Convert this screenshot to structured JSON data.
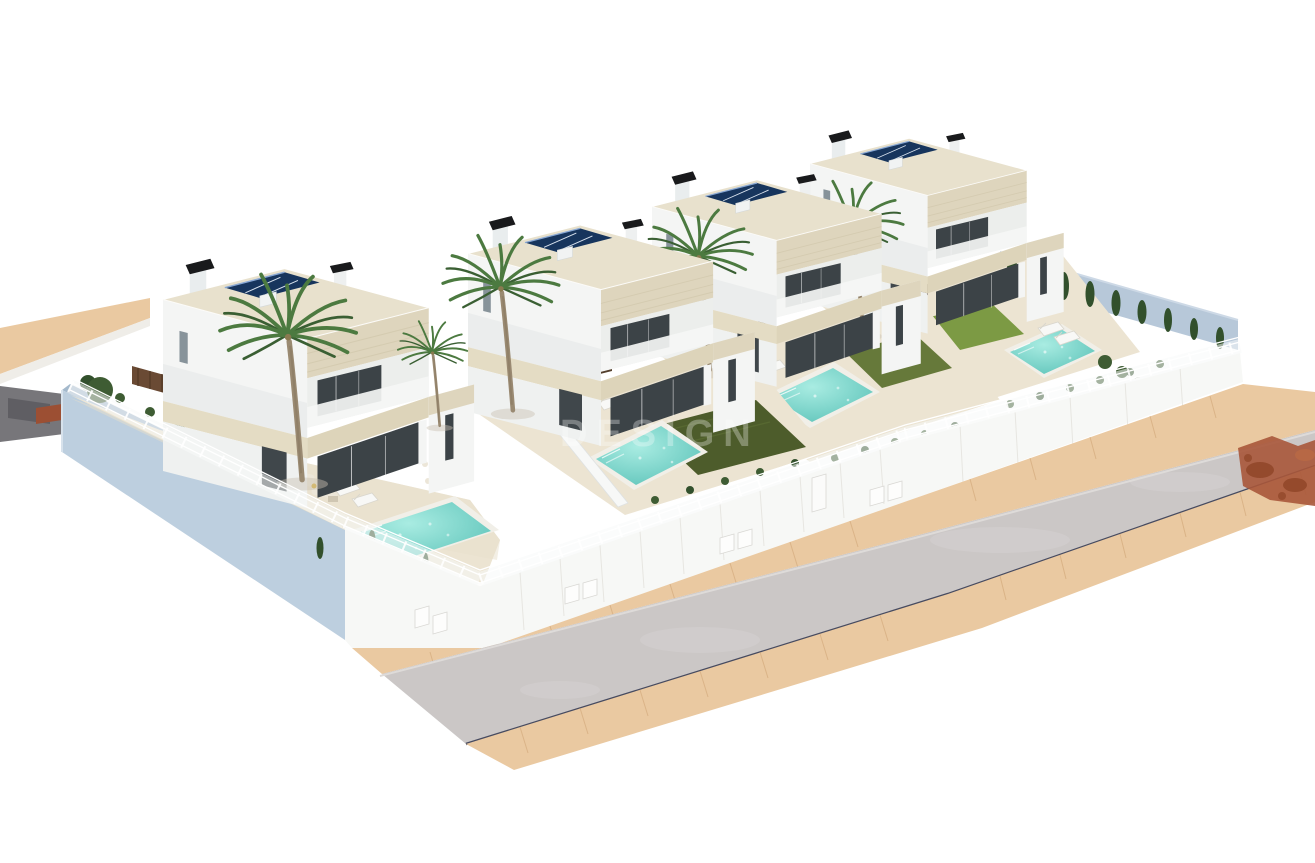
{
  "scene": {
    "watermark": "DESIGN",
    "type": "3d-architectural-render",
    "description": "Aerial 3D render of a row of four modern two-storey white villas, each with a rooftop solar array, black chimney caps, a private turquoise pool, artificial lawn, palm trees and white perimeter fencing on a raised platform with pale-blue retaining walls, fronted by a curved asphalt road with sand-coloured pavements."
  },
  "villas": [
    {
      "id": "villa-1",
      "storeys": 2,
      "solar_modules": 3,
      "pool": true,
      "palms": 2,
      "sun_loungers": 2
    },
    {
      "id": "villa-2",
      "storeys": 2,
      "solar_modules": 3,
      "pool": true,
      "palms": 1,
      "sun_loungers": 2
    },
    {
      "id": "villa-3",
      "storeys": 2,
      "solar_modules": 3,
      "pool": true,
      "palms": 1,
      "sun_loungers": 2
    },
    {
      "id": "villa-4",
      "storeys": 2,
      "solar_modules": 3,
      "pool": true,
      "palms": 1,
      "sun_loungers": 2
    }
  ],
  "ground": {
    "road": "asphalt, bends toward right edge, dark kerb line on lower side",
    "sidewalks": 2,
    "left_path": "sand-coloured path and dark asphalt patch at left edge",
    "shadow": "rust-coloured tree shadow on road at right edge"
  },
  "colors": {
    "bg": "#ffffff",
    "wall-blue": "#bdcfdf",
    "wall-blue-dark": "#a4b9cc",
    "wall-back": "#b7c8d9",
    "villa-white": "#f4f5f4",
    "villa-white-2": "#eff1f0",
    "villa-shade": "#e0e4e5",
    "stone": "#ded5bd",
    "stone-light": "#e4dcc4",
    "roof-deck": "#e8e1cd",
    "glass": "#3c4347",
    "solar": "#17355d",
    "deck": "#ece4d2",
    "pool-coping": "#f1efe8",
    "pool-water": "#5bc2b8",
    "pool-water-light": "#a9ece2",
    "lawn-dark": "#4d5c2b",
    "lawn-mid": "#66793a",
    "lawn-bright": "#7c9a44",
    "road": "#cbc7c6",
    "sidewalk": "#eac9a1",
    "kerb-line": "#474b60",
    "rust": "#a8573a",
    "rust-dark": "#8f4527",
    "chimney": "#191a1c",
    "wood": "#6a4a34",
    "kitchen": "#54402e",
    "furniture": "#ece6d8",
    "pillow": "#d9b242",
    "shrub": "#3e5c33",
    "cypress": "#32502c",
    "palm": "#4c7a40",
    "palm-dark": "#3a5f33",
    "trunk": "#9a8a72",
    "fence": "#f8fafa"
  }
}
